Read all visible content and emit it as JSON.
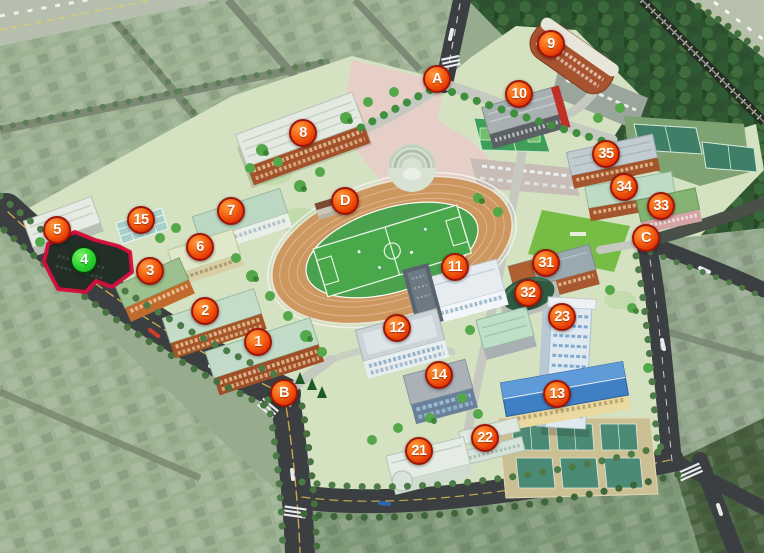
{
  "map": {
    "kind": "university-campus-birdseye-map",
    "selected_building_marker": "4",
    "theme": {
      "marker_fill": "#ee4d0d",
      "marker_rim": "#9c150a",
      "marker_text": "#ffffff",
      "selected_marker_fill": "#22cf2f",
      "selected_marker_rim": "#0c3c10",
      "highlight_outline": "#d60f3c",
      "road": "#3b3f41",
      "forest": "#2f5230",
      "track": "#cd9760",
      "pitch": "#4aa24e"
    },
    "markers": [
      {
        "label": "1",
        "kind": "building",
        "x": 258,
        "y": 342
      },
      {
        "label": "2",
        "kind": "building",
        "x": 205,
        "y": 311
      },
      {
        "label": "3",
        "kind": "building",
        "x": 150,
        "y": 271
      },
      {
        "label": "4",
        "kind": "building",
        "x": 84,
        "y": 260,
        "selected": true
      },
      {
        "label": "5",
        "kind": "building",
        "x": 57,
        "y": 230
      },
      {
        "label": "6",
        "kind": "building",
        "x": 200,
        "y": 247
      },
      {
        "label": "7",
        "kind": "building",
        "x": 231,
        "y": 211
      },
      {
        "label": "8",
        "kind": "building",
        "x": 303,
        "y": 133
      },
      {
        "label": "9",
        "kind": "building",
        "x": 551,
        "y": 44
      },
      {
        "label": "10",
        "kind": "building",
        "x": 519,
        "y": 94
      },
      {
        "label": "11",
        "kind": "building",
        "x": 455,
        "y": 267
      },
      {
        "label": "12",
        "kind": "building",
        "x": 397,
        "y": 328
      },
      {
        "label": "13",
        "kind": "building",
        "x": 557,
        "y": 394
      },
      {
        "label": "14",
        "kind": "building",
        "x": 439,
        "y": 375
      },
      {
        "label": "15",
        "kind": "building",
        "x": 141,
        "y": 220
      },
      {
        "label": "21",
        "kind": "building",
        "x": 419,
        "y": 451
      },
      {
        "label": "22",
        "kind": "building",
        "x": 485,
        "y": 438
      },
      {
        "label": "23",
        "kind": "building",
        "x": 562,
        "y": 317
      },
      {
        "label": "31",
        "kind": "building",
        "x": 546,
        "y": 263
      },
      {
        "label": "32",
        "kind": "building",
        "x": 528,
        "y": 293
      },
      {
        "label": "33",
        "kind": "building",
        "x": 661,
        "y": 206
      },
      {
        "label": "34",
        "kind": "building",
        "x": 624,
        "y": 187
      },
      {
        "label": "35",
        "kind": "building",
        "x": 606,
        "y": 154
      },
      {
        "label": "A",
        "kind": "gate",
        "x": 437,
        "y": 79
      },
      {
        "label": "B",
        "kind": "gate",
        "x": 284,
        "y": 393
      },
      {
        "label": "C",
        "kind": "gate",
        "x": 646,
        "y": 238
      },
      {
        "label": "D",
        "kind": "gate",
        "x": 345,
        "y": 201
      }
    ]
  }
}
